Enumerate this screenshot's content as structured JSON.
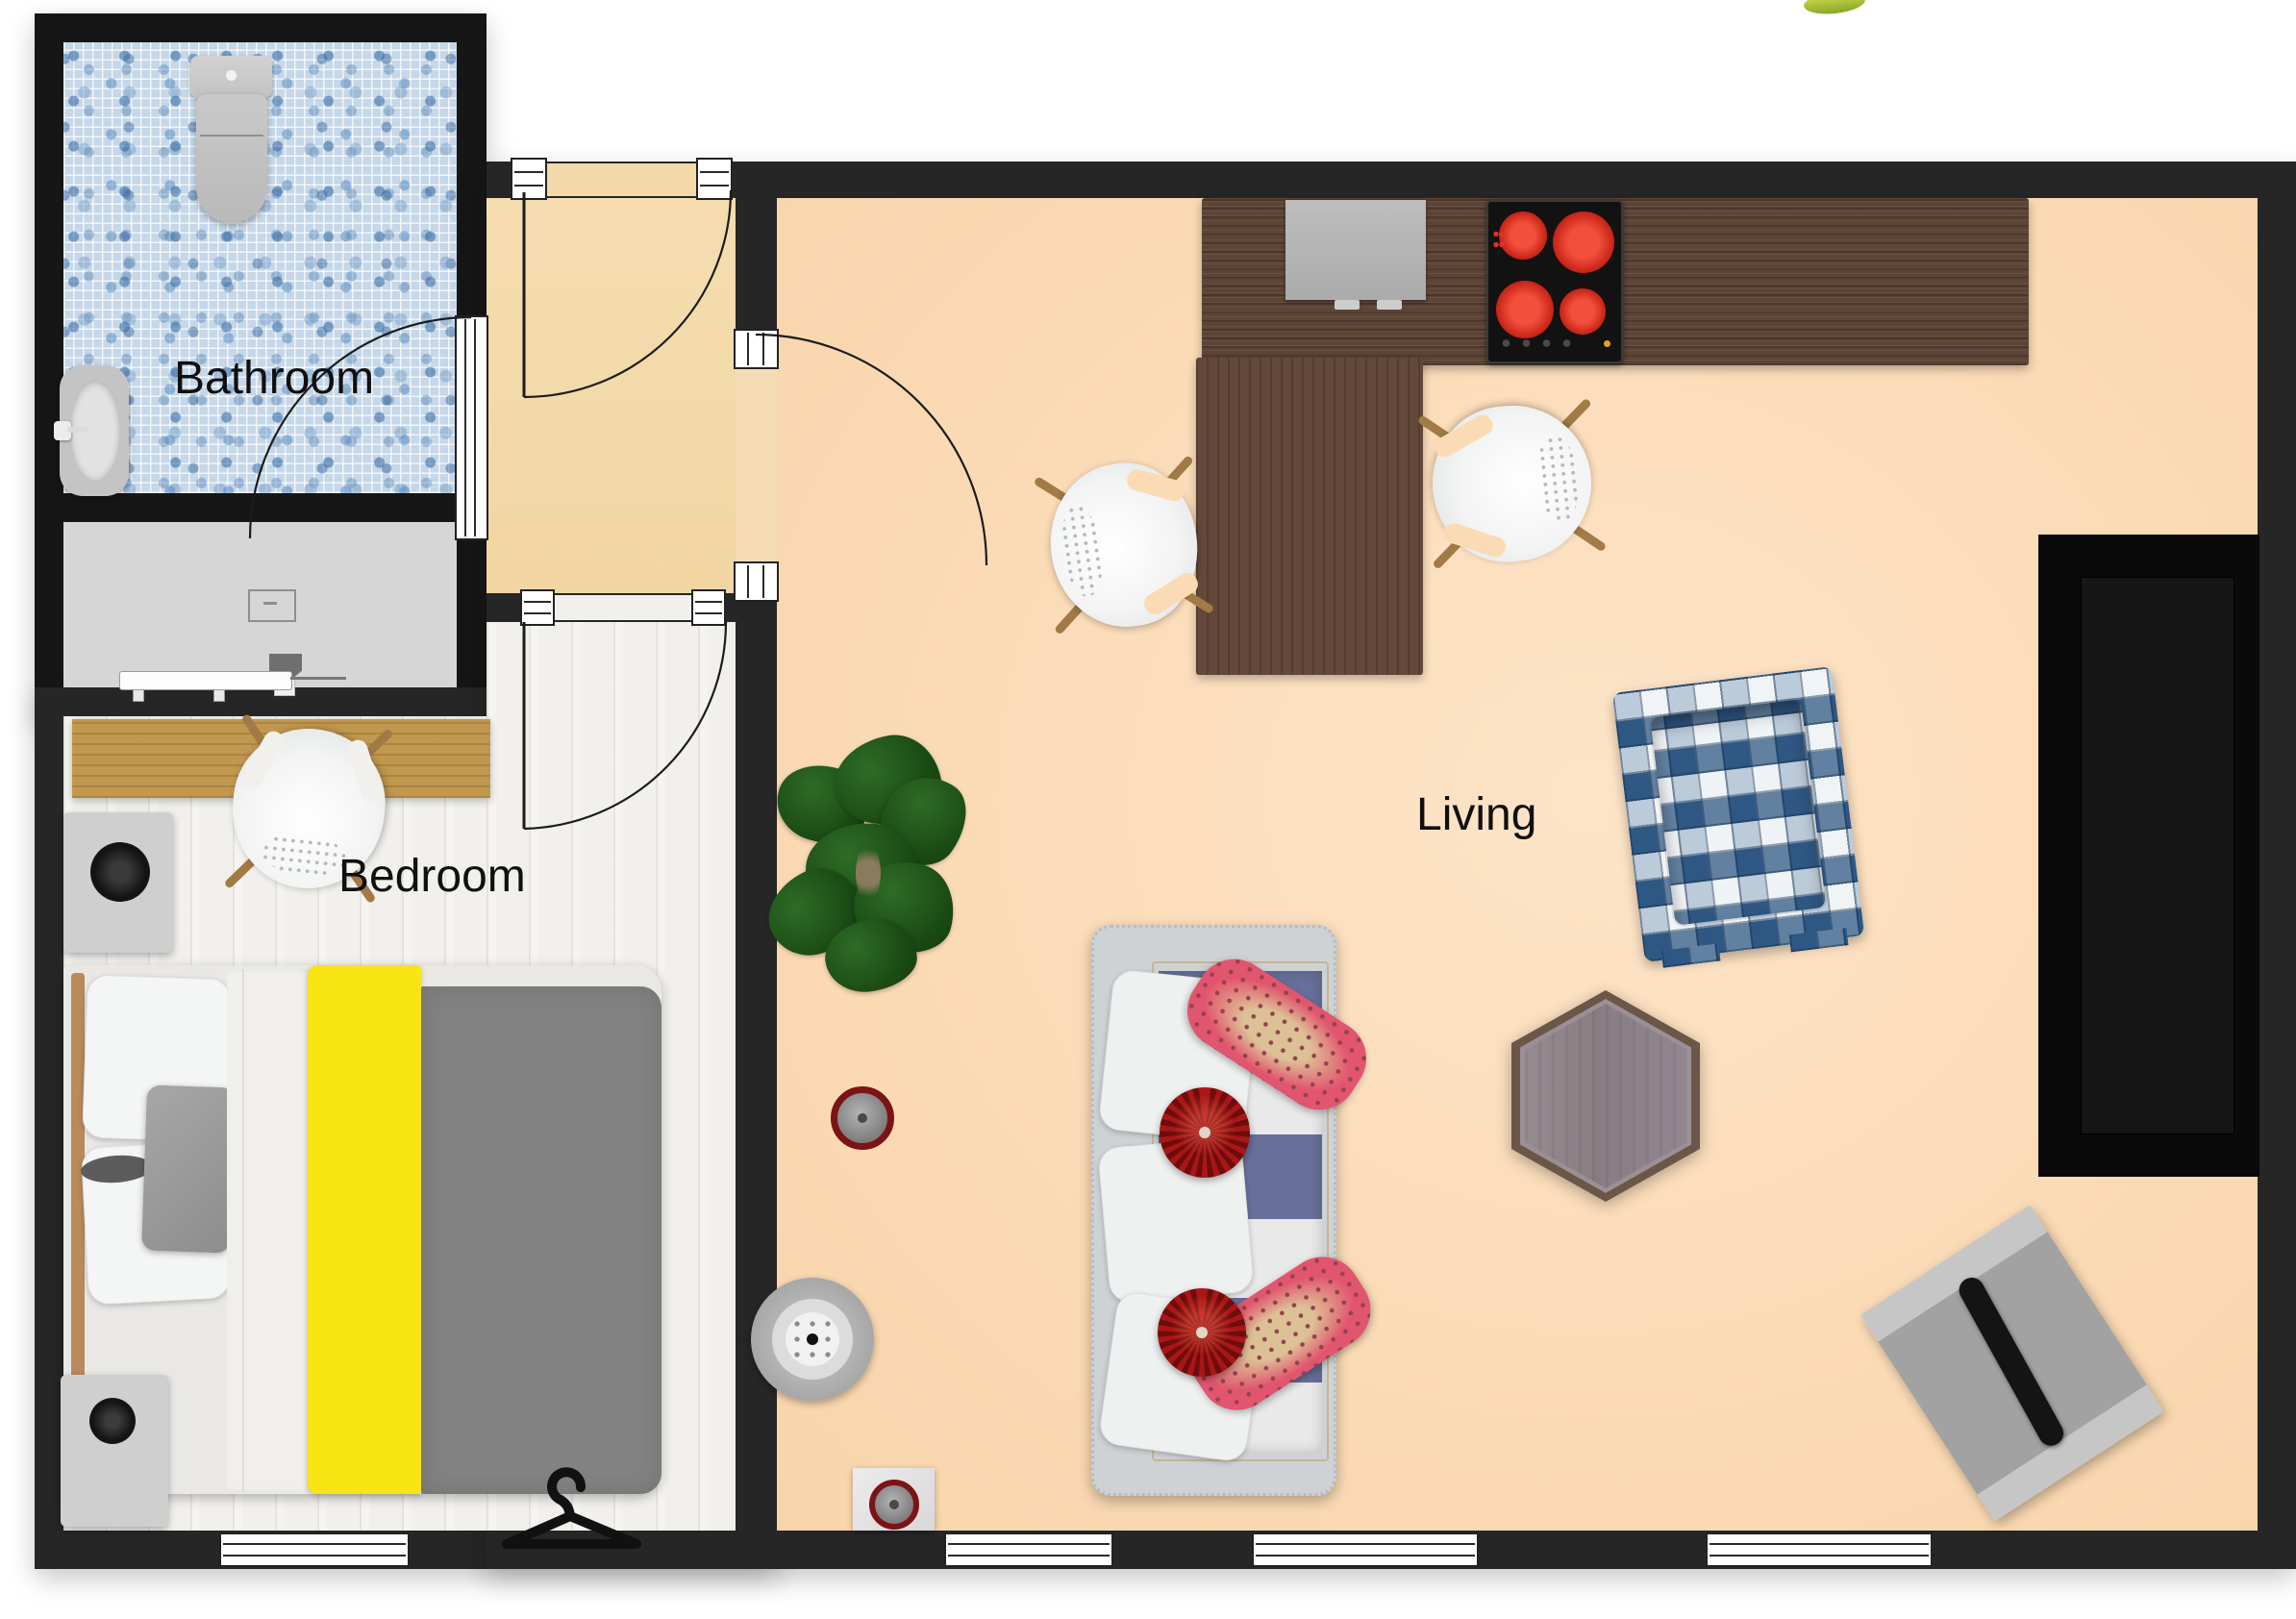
{
  "plan": {
    "type": "2d-floor-plan-render",
    "labels": {
      "bathroom": "Bathroom",
      "bedroom": "Bedroom",
      "living": "Living"
    }
  },
  "palette": {
    "wall": "#262626",
    "living_floor": "#fbdbb6",
    "entry_floor": "#f3d9a9",
    "bedroom_floor": "#f2f0ec",
    "utility_floor": "#d6d6d6",
    "bathroom_tile": "#c5d7e8",
    "counter_wood": "#5d4536",
    "desk_wood": "#c1984f",
    "bed_yellow": "#f9e414",
    "sofa_stripe_navy": "#667099",
    "cushion_red": "#a81616",
    "cushion_pink": "#e2556e",
    "armchair_plaid_blue": "#35608f",
    "burner_red": "#d8281c"
  },
  "furniture": [
    "toilet",
    "pedestal-sink",
    "utility-bench",
    "utility-chair",
    "desk-wardrobe",
    "desk-chair",
    "double-bed",
    "nightstand-speaker",
    "storage-box-speaker",
    "clothes-hanger",
    "kitchen-counter",
    "built-in-appliance",
    "cooktop",
    "dining-table",
    "dining-chair-left",
    "dining-chair-right",
    "potted-plant",
    "sofa",
    "armchair-plaid",
    "hexagon-coffee-table",
    "tv-media-unit",
    "lounger",
    "floor-fan",
    "smoke-detector",
    "floor-box"
  ]
}
